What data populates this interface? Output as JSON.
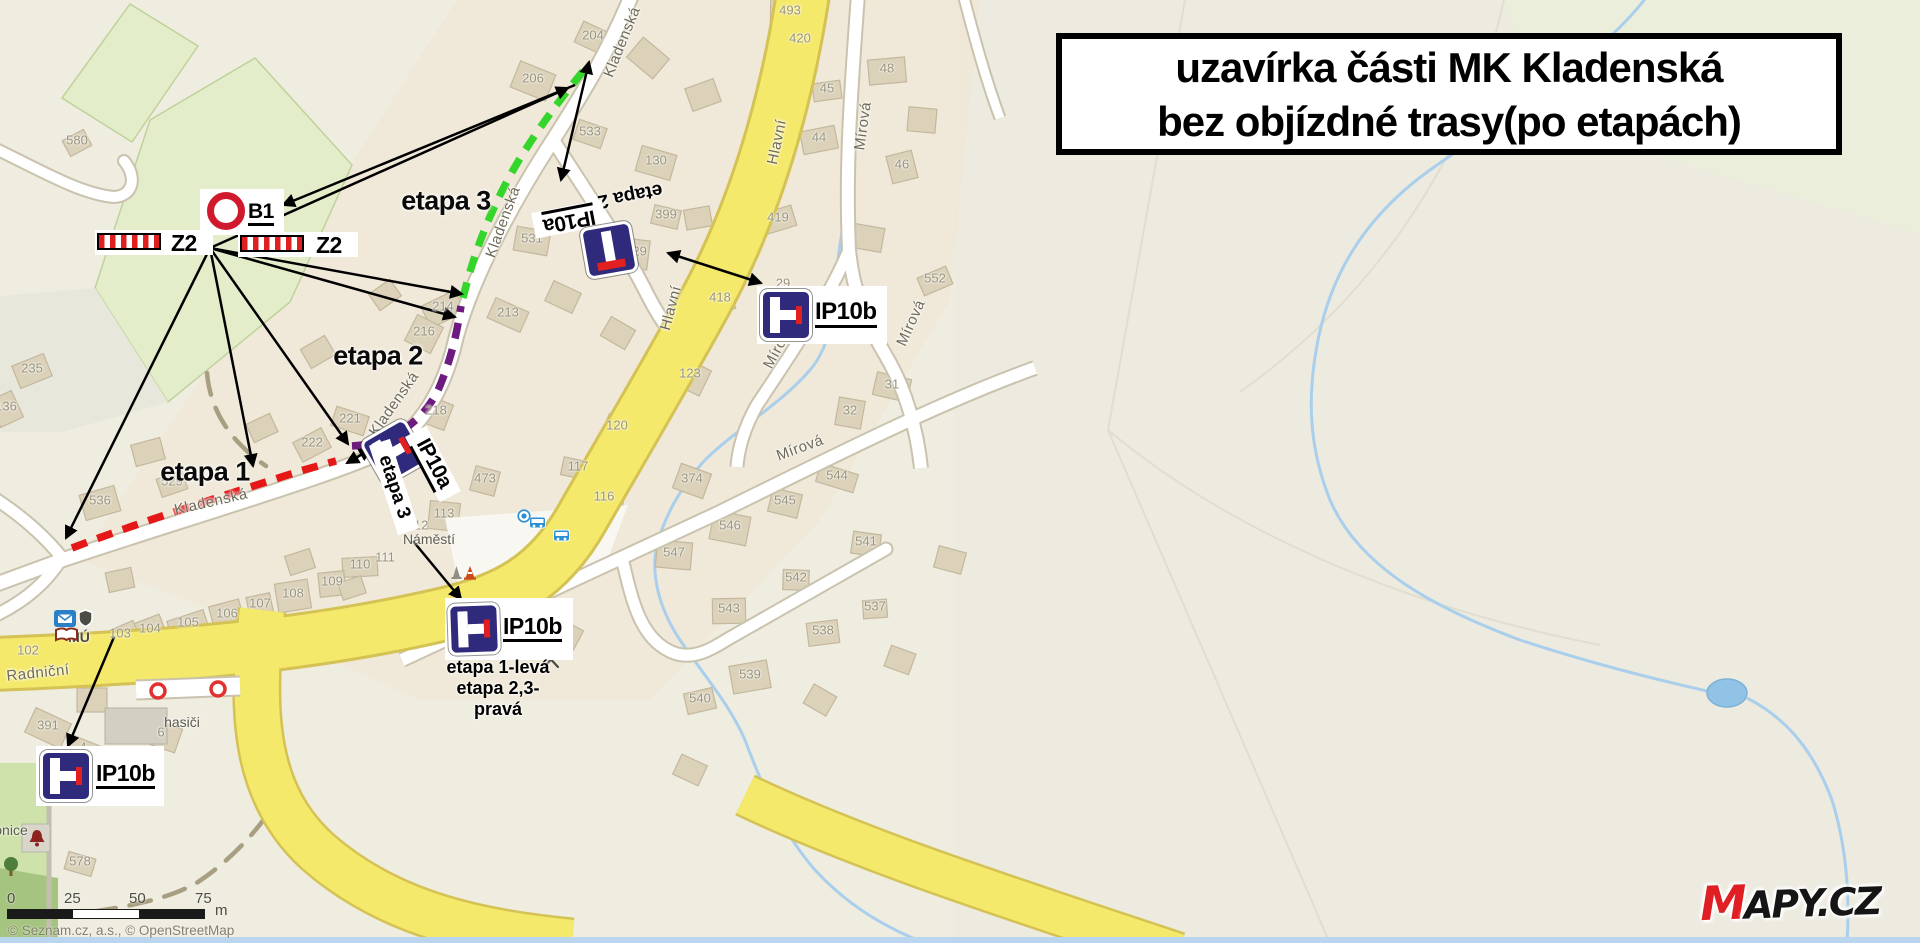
{
  "title": {
    "line1": "uzavírka části MK Kladenská",
    "line2": "bez objízdné trasy(po etapách)"
  },
  "logo": {
    "m": "M",
    "rest": "APY.CZ"
  },
  "attribution": "© Seznam.cz, a.s., © OpenStreetMap",
  "scalebar": {
    "ticks": [
      "0",
      "25",
      "50",
      "75"
    ],
    "unit": "m"
  },
  "annotations": {
    "signs": [
      {
        "id": "b1",
        "type": "B1",
        "label": "B1"
      },
      {
        "id": "z2-left",
        "type": "Z2",
        "label": "Z2"
      },
      {
        "id": "z2-right",
        "type": "Z2",
        "label": "Z2"
      },
      {
        "id": "ip10a-top",
        "type": "IP10a",
        "label": "IP10a",
        "note": "etapa 2"
      },
      {
        "id": "ip10a-center",
        "type": "IP10a",
        "label": "IP10a",
        "note": "etapa 3"
      },
      {
        "id": "ip10b-right",
        "type": "IP10b",
        "label": "IP10b"
      },
      {
        "id": "ip10b-center",
        "type": "IP10b",
        "label": "IP10b",
        "notes": [
          "etapa 1-levá",
          "etapa 2,3-",
          "pravá"
        ]
      },
      {
        "id": "ip10b-left",
        "type": "IP10b",
        "label": "IP10b"
      }
    ],
    "stages": [
      {
        "name": "etapa 1",
        "color": "#e51717",
        "path": "M72,548 C140,522 235,492 300,471 L336,461",
        "label": {
          "text": "etapa 1",
          "x": 205,
          "y": 472
        }
      },
      {
        "name": "etapa 2",
        "color": "#6d1b7e",
        "path": "M352,446 C392,444 424,421 439,388 C452,357 457,332 461,306",
        "label": {
          "text": "etapa 2",
          "x": 378,
          "y": 356
        }
      },
      {
        "name": "etapa 3",
        "color": "#35d62c",
        "path": "M463,298 C474,252 490,212 512,172 C532,137 557,103 584,70",
        "label": {
          "text": "etapa 3",
          "x": 446,
          "y": 201
        }
      }
    ],
    "arrows": [
      {
        "x1": 575,
        "y1": 85,
        "x2": 283,
        "y2": 205,
        "both": false
      },
      {
        "x1": 210,
        "y1": 248,
        "x2": 568,
        "y2": 88,
        "both": false
      },
      {
        "x1": 589,
        "y1": 62,
        "x2": 561,
        "y2": 180,
        "both": true
      },
      {
        "x1": 210,
        "y1": 248,
        "x2": 462,
        "y2": 294,
        "both": false
      },
      {
        "x1": 210,
        "y1": 248,
        "x2": 455,
        "y2": 317,
        "both": false
      },
      {
        "x1": 210,
        "y1": 248,
        "x2": 66,
        "y2": 538,
        "both": false
      },
      {
        "x1": 210,
        "y1": 248,
        "x2": 253,
        "y2": 466,
        "both": false
      },
      {
        "x1": 210,
        "y1": 248,
        "x2": 348,
        "y2": 444,
        "both": false
      },
      {
        "x1": 668,
        "y1": 253,
        "x2": 761,
        "y2": 283,
        "both": true
      },
      {
        "x1": 413,
        "y1": 541,
        "x2": 461,
        "y2": 599,
        "both": false
      },
      {
        "x1": 114,
        "y1": 637,
        "x2": 68,
        "y2": 746,
        "both": false
      },
      {
        "x1": 347,
        "y1": 463,
        "x2": 371,
        "y2": 449,
        "both": true
      }
    ],
    "gates": [
      {
        "x": 158,
        "y": 691
      },
      {
        "x": 218,
        "y": 689
      }
    ]
  },
  "map": {
    "street_labels": [
      {
        "text": "Kladenská",
        "x": 622,
        "y": 42,
        "rot": -68
      },
      {
        "text": "Kladenská",
        "x": 503,
        "y": 222,
        "rot": -70
      },
      {
        "text": "Kladenská",
        "x": 394,
        "y": 404,
        "rot": -55
      },
      {
        "text": "Kladenská",
        "x": 211,
        "y": 502,
        "rot": -13
      },
      {
        "text": "Hlavní",
        "x": 777,
        "y": 142,
        "rot": -78
      },
      {
        "text": "Hlavní",
        "x": 671,
        "y": 308,
        "rot": -75
      },
      {
        "text": "Mírová",
        "x": 863,
        "y": 126,
        "rot": -82
      },
      {
        "text": "Mírová",
        "x": 911,
        "y": 323,
        "rot": -66
      },
      {
        "text": "Mírová",
        "x": 779,
        "y": 346,
        "rot": -62
      },
      {
        "text": "Mírová",
        "x": 800,
        "y": 448,
        "rot": -20
      },
      {
        "text": "Mírová",
        "x": 470,
        "y": 630,
        "rot": -33
      },
      {
        "text": "Radniční",
        "x": 38,
        "y": 673,
        "rot": -6
      }
    ],
    "poi_labels": [
      {
        "text": "Náměstí",
        "x": 429,
        "y": 539
      },
      {
        "text": "hasiči",
        "x": 182,
        "y": 722
      },
      {
        "text": "zvonice",
        "x": 4,
        "y": 830
      },
      {
        "text": "MÚ",
        "x": 79,
        "y": 637
      }
    ],
    "house_numbers": [
      {
        "n": "580",
        "x": 77,
        "y": 140
      },
      {
        "n": "204",
        "x": 593,
        "y": 35
      },
      {
        "n": "206",
        "x": 533,
        "y": 78
      },
      {
        "n": "533",
        "x": 590,
        "y": 131
      },
      {
        "n": "130",
        "x": 656,
        "y": 160
      },
      {
        "n": "399",
        "x": 666,
        "y": 214
      },
      {
        "n": "531",
        "x": 532,
        "y": 238
      },
      {
        "n": "429",
        "x": 636,
        "y": 251
      },
      {
        "n": "29",
        "x": 783,
        "y": 283,
        "nb": 1
      },
      {
        "n": "493",
        "x": 790,
        "y": 10
      },
      {
        "n": "420",
        "x": 800,
        "y": 38
      },
      {
        "n": "48",
        "x": 887,
        "y": 68
      },
      {
        "n": "45",
        "x": 827,
        "y": 88
      },
      {
        "n": "44",
        "x": 819,
        "y": 137
      },
      {
        "n": "46",
        "x": 902,
        "y": 164
      },
      {
        "n": "419",
        "x": 778,
        "y": 217
      },
      {
        "n": "418",
        "x": 720,
        "y": 297
      },
      {
        "n": "552",
        "x": 935,
        "y": 278
      },
      {
        "n": "214",
        "x": 443,
        "y": 306
      },
      {
        "n": "216",
        "x": 424,
        "y": 331
      },
      {
        "n": "213",
        "x": 508,
        "y": 312
      },
      {
        "n": "218",
        "x": 436,
        "y": 410
      },
      {
        "n": "221",
        "x": 350,
        "y": 418
      },
      {
        "n": "473",
        "x": 485,
        "y": 478
      },
      {
        "n": "117",
        "x": 578,
        "y": 466
      },
      {
        "n": "116",
        "x": 604,
        "y": 496
      },
      {
        "n": "113",
        "x": 444,
        "y": 513
      },
      {
        "n": "112",
        "x": 418,
        "y": 525,
        "nb": 1
      },
      {
        "n": "111",
        "x": 385,
        "y": 557,
        "nb": 1
      },
      {
        "n": "110",
        "x": 360,
        "y": 564
      },
      {
        "n": "109",
        "x": 332,
        "y": 581
      },
      {
        "n": "108",
        "x": 293,
        "y": 593
      },
      {
        "n": "107",
        "x": 260,
        "y": 603
      },
      {
        "n": "106",
        "x": 227,
        "y": 613
      },
      {
        "n": "105",
        "x": 188,
        "y": 622
      },
      {
        "n": "104",
        "x": 150,
        "y": 628
      },
      {
        "n": "103",
        "x": 120,
        "y": 633
      },
      {
        "n": "102",
        "x": 28,
        "y": 650
      },
      {
        "n": "123",
        "x": 690,
        "y": 373
      },
      {
        "n": "120",
        "x": 617,
        "y": 425
      },
      {
        "n": "374",
        "x": 692,
        "y": 478
      },
      {
        "n": "544",
        "x": 837,
        "y": 475
      },
      {
        "n": "545",
        "x": 785,
        "y": 500
      },
      {
        "n": "546",
        "x": 730,
        "y": 525
      },
      {
        "n": "541",
        "x": 866,
        "y": 541
      },
      {
        "n": "547",
        "x": 674,
        "y": 552
      },
      {
        "n": "542",
        "x": 796,
        "y": 577
      },
      {
        "n": "543",
        "x": 729,
        "y": 608
      },
      {
        "n": "537",
        "x": 875,
        "y": 606
      },
      {
        "n": "538",
        "x": 823,
        "y": 630
      },
      {
        "n": "539",
        "x": 750,
        "y": 674
      },
      {
        "n": "540",
        "x": 700,
        "y": 698
      },
      {
        "n": "536",
        "x": 100,
        "y": 500
      },
      {
        "n": "529",
        "x": 172,
        "y": 481
      },
      {
        "n": "235",
        "x": 32,
        "y": 368
      },
      {
        "n": "136",
        "x": 6,
        "y": 406
      },
      {
        "n": "222",
        "x": 312,
        "y": 442
      },
      {
        "n": "391",
        "x": 48,
        "y": 725
      },
      {
        "n": "4",
        "x": 83,
        "y": 747
      },
      {
        "n": "6",
        "x": 161,
        "y": 732
      },
      {
        "n": "578",
        "x": 80,
        "y": 861
      },
      {
        "n": "31",
        "x": 892,
        "y": 384
      },
      {
        "n": "32",
        "x": 850,
        "y": 410
      }
    ],
    "extra_buildings": [
      [
        648,
        58,
        34,
        26,
        40
      ],
      [
        703,
        95,
        30,
        24,
        -20
      ],
      [
        563,
        297,
        30,
        22,
        25
      ],
      [
        618,
        333,
        28,
        22,
        30
      ],
      [
        385,
        295,
        26,
        20,
        -35
      ],
      [
        318,
        352,
        28,
        22,
        -30
      ],
      [
        262,
        428,
        26,
        20,
        -25
      ],
      [
        148,
        452,
        30,
        22,
        -15
      ],
      [
        92,
        700,
        30,
        24,
        0
      ],
      [
        300,
        562,
        26,
        20,
        -18
      ],
      [
        352,
        588,
        24,
        18,
        -18
      ],
      [
        868,
        238,
        30,
        24,
        10
      ],
      [
        922,
        120,
        28,
        24,
        5
      ],
      [
        760,
        152,
        26,
        22,
        -15
      ],
      [
        698,
        218,
        26,
        20,
        -10
      ],
      [
        640,
        420,
        24,
        20,
        -20
      ],
      [
        120,
        580,
        26,
        20,
        -12
      ],
      [
        566,
        634,
        28,
        22,
        28
      ],
      [
        820,
        700,
        26,
        22,
        30
      ],
      [
        900,
        660,
        26,
        22,
        20
      ],
      [
        950,
        560,
        28,
        22,
        15
      ],
      [
        690,
        770,
        28,
        22,
        25
      ]
    ],
    "icons": [
      {
        "type": "post",
        "x": 54,
        "y": 610
      },
      {
        "type": "shield",
        "x": 78,
        "y": 609
      },
      {
        "type": "book",
        "x": 54,
        "y": 627
      },
      {
        "type": "bus",
        "x": 529,
        "y": 516
      },
      {
        "type": "bus",
        "x": 553,
        "y": 529
      },
      {
        "type": "stop-dot",
        "x": 517,
        "y": 509
      },
      {
        "type": "cone-gray",
        "x": 451,
        "y": 565
      },
      {
        "type": "cone",
        "x": 463,
        "y": 565
      },
      {
        "type": "fork",
        "x": 541,
        "y": 650
      },
      {
        "type": "bell",
        "x": 24,
        "y": 826
      },
      {
        "type": "tree",
        "x": 2,
        "y": 856
      }
    ]
  }
}
